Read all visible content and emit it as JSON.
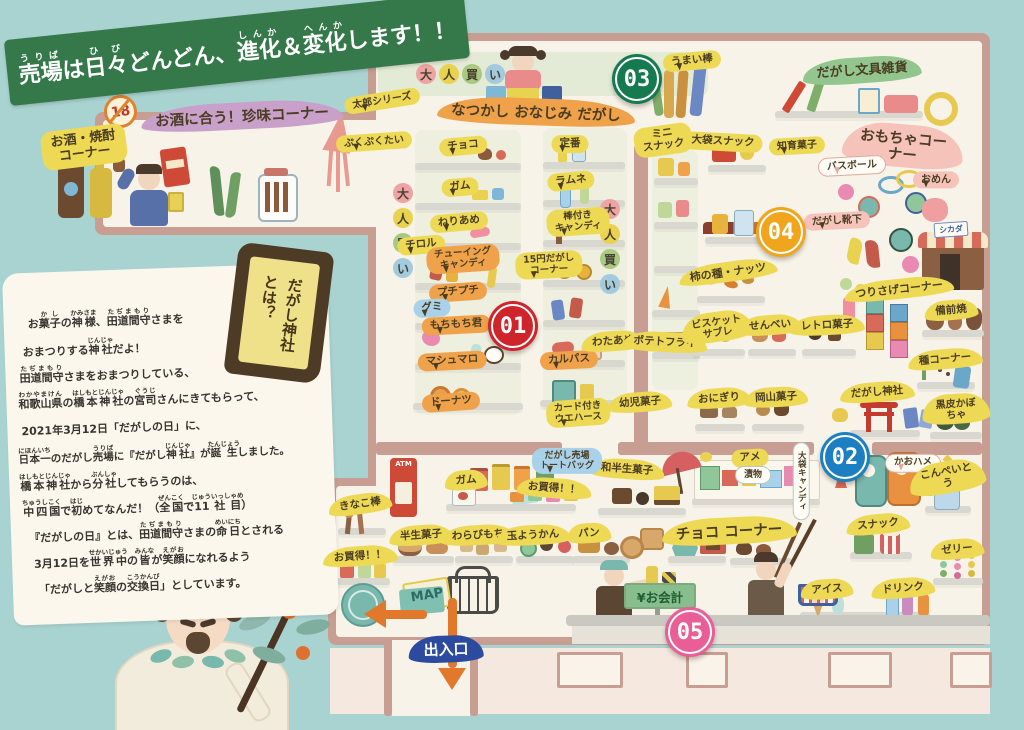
{
  "banner": {
    "segments": [
      [
        "売場",
        "うりば"
      ],
      [
        "は"
      ],
      [
        "日々",
        "ひび"
      ],
      [
        "どんどん、"
      ],
      [
        "進化",
        "しんか"
      ],
      [
        "＆"
      ],
      [
        "変化",
        "へんか"
      ],
      [
        "します！！"
      ]
    ]
  },
  "signs": {
    "age_badge": "18",
    "kaikei": "¥お会計",
    "map": "MAP",
    "exit": "出入口",
    "atm": "ATM",
    "shikada": "シカダ"
  },
  "otona_gai": {
    "chars": [
      "大",
      "人",
      "買",
      "い"
    ]
  },
  "stops": {
    "s01": "01",
    "s02": "02",
    "s03": "03",
    "s04": "04",
    "s05": "05"
  },
  "shrine_sign": {
    "text": "だがし神社\nとは？"
  },
  "labels": {
    "sake_corner": {
      "text": "お酒・焼酎\nコーナー"
    },
    "chinmi_corner": {
      "text": "お酒に合う！珍味コーナー"
    },
    "taro_series": {
      "text": "太郎シリーズ"
    },
    "pukupuku_tai": {
      "text": "ぷくぷくたい"
    },
    "natsukashi": {
      "text": "なつかし おなじみ だがし"
    },
    "umaibo": {
      "text": "うまい棒"
    },
    "bungu_zakka": {
      "text": "だがし文具雑貨"
    },
    "omocha_corner": {
      "text": "おもちゃコーナー"
    },
    "mini_snack": {
      "text": "ミニ\nスナック"
    },
    "obukuro_snack": {
      "text": "大袋スナック"
    },
    "chiiku_gashi": {
      "text": "知育菓子"
    },
    "bath_ball": {
      "text": "バスボール"
    },
    "omen": {
      "text": "おめん"
    },
    "dagashi_socks": {
      "text": "だがし靴下"
    },
    "choco": {
      "text": "チョコ"
    },
    "teiban": {
      "text": "定番"
    },
    "gum_upper": {
      "text": "ガム"
    },
    "ramune": {
      "text": "ラムネ"
    },
    "neriame": {
      "text": "ねりあめ"
    },
    "bo_tsuki_candy": {
      "text": "棒付き\nキャンディ"
    },
    "tirol": {
      "text": "チロル"
    },
    "chewing_candy": {
      "text": "チューイング\nキャンディ"
    },
    "jugoen_corner": {
      "text": "15円だがし\nコーナー"
    },
    "puchipuchi": {
      "text": "プチプチ"
    },
    "gumi": {
      "text": "グミ"
    },
    "mochimochi_kun": {
      "text": "もちもち君"
    },
    "marshmallow": {
      "text": "マシュマロ"
    },
    "karupasu": {
      "text": "カルパス"
    },
    "wataame": {
      "text": "わたあめ"
    },
    "potato_fry": {
      "text": "ポテトフライ"
    },
    "donut": {
      "text": "ドーナツ"
    },
    "card_wafer": {
      "text": "カード付き\nウエハース"
    },
    "yoji_gashi": {
      "text": "幼児菓子"
    },
    "kaki_nuts": {
      "text": "柿の種・ナッツ"
    },
    "biscuit_sable": {
      "text": "ビスケット\nサブレ"
    },
    "senbei": {
      "text": "せんべい"
    },
    "retro_gashi": {
      "text": "レトロ菓子"
    },
    "tsurisage_corner": {
      "text": "つりさげコーナー"
    },
    "bizen_yaki": {
      "text": "備前焼"
    },
    "tane_corner": {
      "text": "種コーナー"
    },
    "onigiri": {
      "text": "おにぎり"
    },
    "okayama_gashi": {
      "text": "岡山菓子"
    },
    "dagashi_jinja": {
      "text": "だがし神社"
    },
    "kurokawa_kabocha": {
      "text": "黒皮かぼちゃ"
    },
    "ame": {
      "text": "アメ"
    },
    "tsukemono": {
      "text": "漬物"
    },
    "obukuro_candy": {
      "text": "大袋キャンディ"
    },
    "kaohame": {
      "text": "かおハメ"
    },
    "konpeito": {
      "text": "こんぺいとう"
    },
    "snack_right": {
      "text": "スナック"
    },
    "jelly": {
      "text": "ゼリー"
    },
    "ice": {
      "text": "アイス"
    },
    "drink": {
      "text": "ドリンク"
    },
    "choco_corner": {
      "text": "チョコ コーナー"
    },
    "wa_hannama_gashi": {
      "text": "和半生菓子"
    },
    "okaidoku_mid": {
      "text": "お買得！！"
    },
    "tote_bag": {
      "text": "だがし売場\nトートバッグ"
    },
    "gum_lower": {
      "text": "ガム"
    },
    "hannama_gashi": {
      "text": "半生菓子"
    },
    "warabimochi": {
      "text": "わらびもち"
    },
    "tama_yokan": {
      "text": "玉ようかん"
    },
    "pan": {
      "text": "パン"
    },
    "kinako_bo": {
      "text": "きなこ棒"
    },
    "okaidoku_left": {
      "text": "お買得！！"
    }
  },
  "note": {
    "lines": [
      [
        [
          "お"
        ],
        [
          "菓子",
          "かし"
        ],
        [
          "の"
        ],
        [
          "神様",
          "かみさま"
        ],
        [
          "、"
        ],
        [
          "田道間守",
          "たぢまもり"
        ],
        [
          "さまを"
        ]
      ],
      [
        [
          "おまつりする"
        ],
        [
          "神社",
          "じんじゃ"
        ],
        [
          "だよ！"
        ]
      ],
      [
        [
          "田道間守",
          "たぢまもり"
        ],
        [
          "さまをおまつりしている、"
        ]
      ],
      [
        [
          "和歌山県",
          "わかやまけん"
        ],
        [
          "の"
        ],
        [
          "橋本神社",
          "はしもとじんじゃ"
        ],
        [
          "の"
        ],
        [
          "宮司",
          "ぐうじ"
        ],
        [
          "さんにきてもらって、"
        ]
      ],
      [
        [
          "2021年3月12日「だがしの日」に、"
        ]
      ],
      [
        [
          "日本一",
          "にほんいち"
        ],
        [
          "のだがし"
        ],
        [
          "売場",
          "うりば"
        ],
        [
          "に『だがし"
        ],
        [
          "神社",
          "じんじゃ"
        ],
        [
          "』が"
        ],
        [
          "誕生",
          "たんじょう"
        ],
        [
          "しました。"
        ]
      ],
      [
        [
          "橋本神社",
          "はしもとじんじゃ"
        ],
        [
          "から"
        ],
        [
          "分社",
          "ぶんしゃ"
        ],
        [
          "してもらうのは、"
        ]
      ],
      [
        [
          "中四国",
          "ちゅうしこく"
        ],
        [
          "で"
        ],
        [
          "初",
          "はじ"
        ],
        [
          "めてなんだ！（"
        ],
        [
          "全国",
          "ぜんこく"
        ],
        [
          "で"
        ],
        [
          "11社目",
          "じゅういっしゃめ"
        ],
        [
          "）"
        ]
      ],
      [
        [
          "『だがしの日』とは、"
        ],
        [
          "田道間守",
          "たぢまもり"
        ],
        [
          "さまの"
        ],
        [
          "命日",
          "めいにち"
        ],
        [
          "とされる"
        ]
      ],
      [
        [
          "3月12日を"
        ],
        [
          "世界中",
          "せかいじゅう"
        ],
        [
          "の"
        ],
        [
          "皆",
          "みんな"
        ],
        [
          "が"
        ],
        [
          "笑顔",
          "えがお"
        ],
        [
          "になれるよう"
        ]
      ],
      [
        [
          "「だがしと"
        ],
        [
          "笑顔",
          "えがお"
        ],
        [
          "の"
        ],
        [
          "交換日",
          "こうかんび"
        ],
        [
          "」としています。"
        ]
      ]
    ]
  },
  "palette": {
    "background": "#a9d3d0",
    "panel": "#f7f3e8",
    "border": "#c89e92",
    "banner_green": "#35794b",
    "label_yellow": "#eed955",
    "label_orange": "#f0a24a",
    "label_blue": "#a9d2ea",
    "label_pink": "#f6c3ba",
    "arc_green": "#93c58f",
    "arc_purple": "#c8a0ca",
    "stop01_red": "#d0242b",
    "stop02_blue": "#1b7fc2",
    "stop03_green": "#157a4f",
    "stop04_orange": "#f0a51c",
    "stop05_pink": "#e95e96",
    "exit_blue": "#2d4b9e",
    "kaikei_green": "#88bd8e",
    "arrow_orange": "#e2782c"
  }
}
